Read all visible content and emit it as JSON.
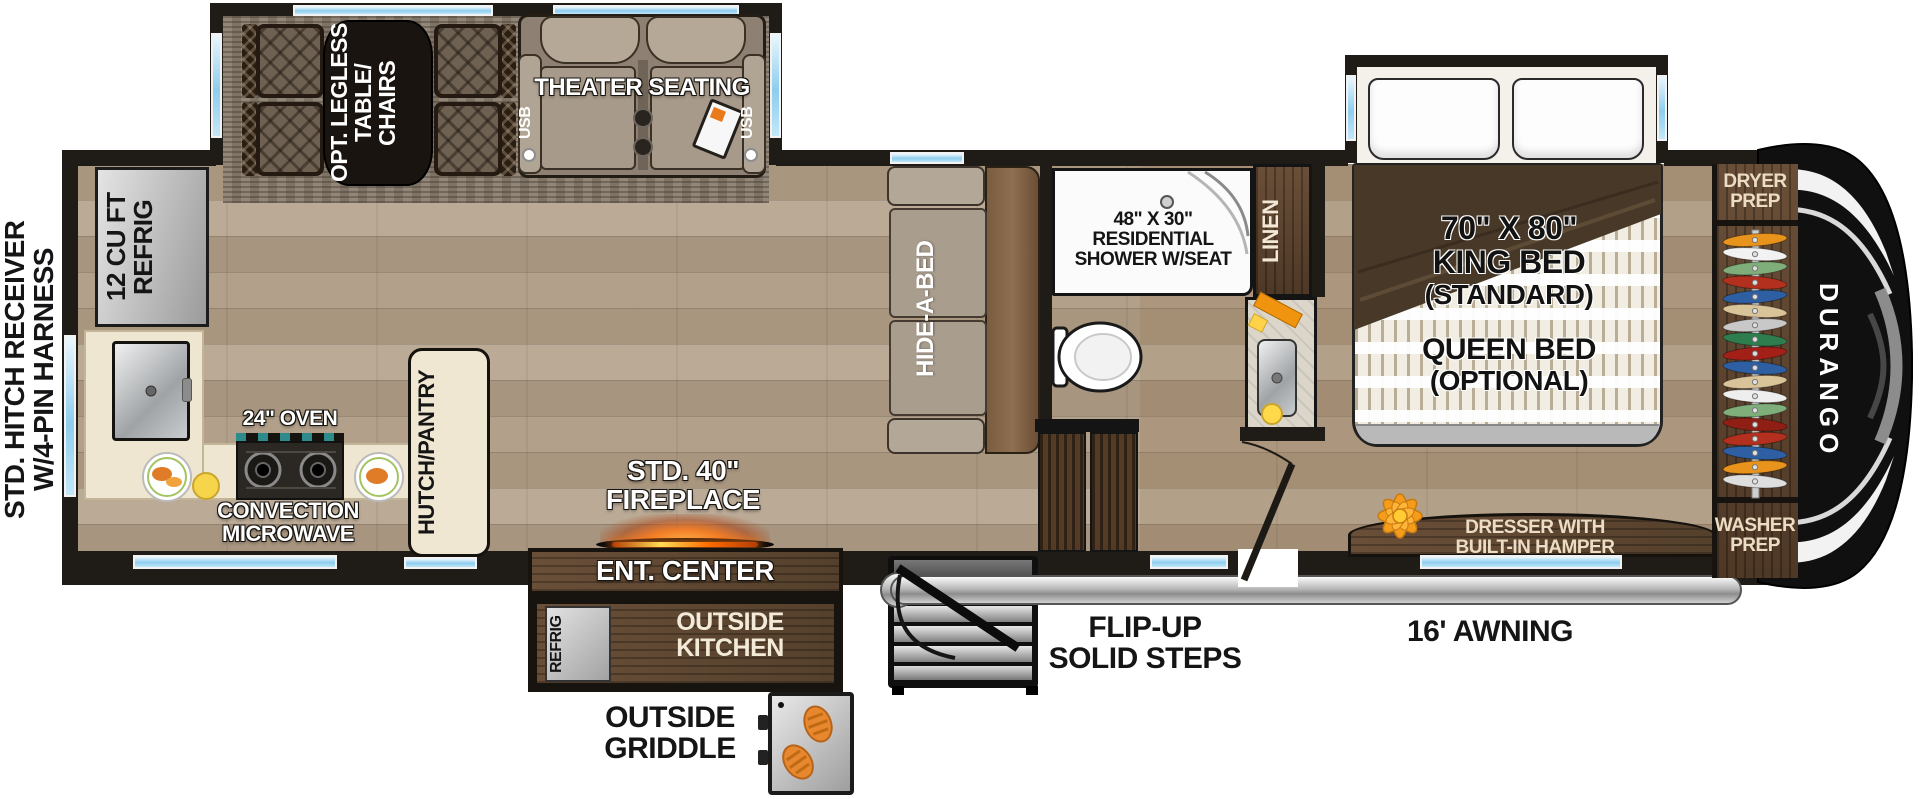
{
  "exterior": {
    "hitch_line1": "STD. HITCH RECEIVER",
    "hitch_line2": "W/4-PIN HARNESS",
    "awning": "16' AWNING",
    "steps_line1": "FLIP-UP",
    "steps_line2": "SOLID STEPS",
    "griddle_line1": "OUTSIDE",
    "griddle_line2": "GRIDDLE"
  },
  "brand": {
    "name": "DURANGO"
  },
  "kitchen": {
    "refrig_line1": "12 CU FT",
    "refrig_line2": "REFRIG",
    "oven": "24\" OVEN",
    "micro_line1": "CONVECTION",
    "micro_line2": "MICROWAVE",
    "hutch": "HUTCH/PANTRY"
  },
  "living": {
    "table_line1": "OPT. LEGLESS",
    "table_line2": "TABLE/",
    "table_line3": "CHAIRS",
    "theater": "THEATER SEATING",
    "usb": "USB",
    "sofa": "HIDE-A-BED",
    "fireplace_line1": "STD. 40\"",
    "fireplace_line2": "FIREPLACE",
    "ent_center": "ENT. CENTER"
  },
  "outside_kitchen": {
    "line1": "OUTSIDE",
    "line2": "KITCHEN",
    "refrig": "REFRIG"
  },
  "bath": {
    "shower_line1": "48\" X 30\"",
    "shower_line2": "RESIDENTIAL",
    "shower_line3": "SHOWER W/SEAT",
    "linen": "LINEN"
  },
  "bedroom": {
    "king_line1": "70\" X 80\"",
    "king_line2": "KING BED",
    "king_line3": "(STANDARD)",
    "queen_line1": "QUEEN BED",
    "queen_line2": "(OPTIONAL)",
    "dresser_line1": "DRESSER WITH",
    "dresser_line2": "BUILT-IN HAMPER"
  },
  "wardrobe": {
    "dryer_line1": "DRYER",
    "dryer_line2": "PREP",
    "washer_line1": "WASHER",
    "washer_line2": "PREP",
    "hanger_colors": [
      "#e8931c",
      "#f2f2f2",
      "#7fae7a",
      "#b3301e",
      "#2e5fa3",
      "#d9c49a",
      "#c8c8c8",
      "#2e7d4f",
      "#a32019",
      "#2e5fa3",
      "#d9c49a",
      "#eeeeee",
      "#7fae7a",
      "#8f1f14",
      "#b3301e",
      "#2e5fa3",
      "#e8931c",
      "#dedede"
    ]
  },
  "palette": {
    "wall": "#1f1b17",
    "floor_wood": "#b2a08a",
    "rug": "#8a7e6f",
    "cabinet_wood": "#5d452f",
    "counter_cream": "#efe6d1",
    "window_blue": "#8ecdee",
    "awning_gray": "#b9b9b9",
    "fireplace_glow": "#ff7a1a",
    "flower_orange": "#f59d1b",
    "cap_black": "#101010"
  }
}
